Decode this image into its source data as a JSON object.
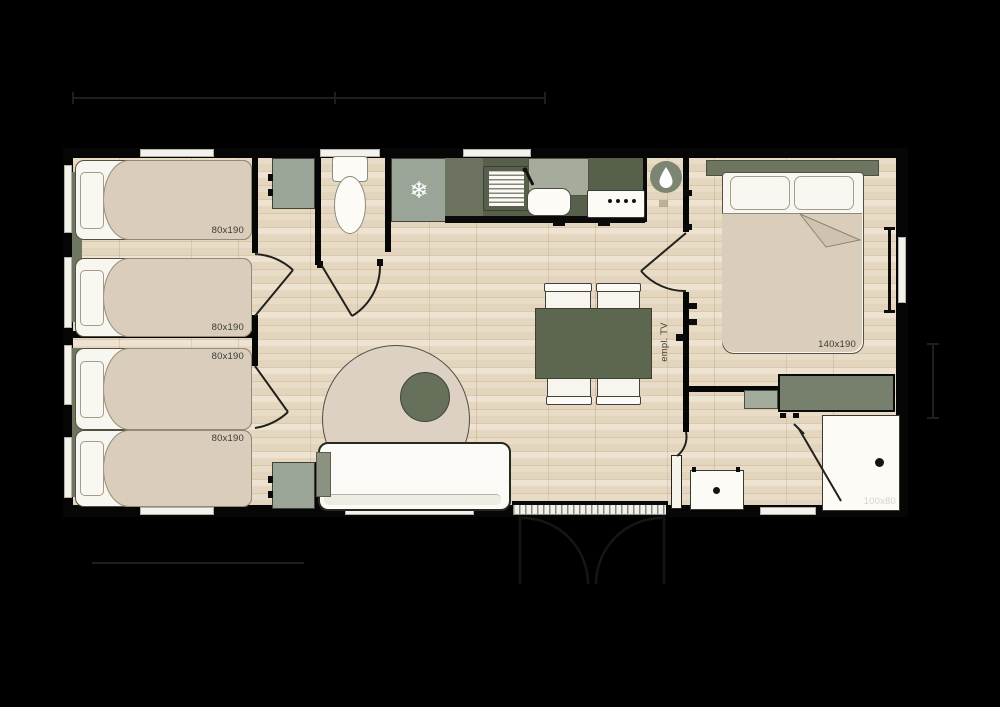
{
  "plan_type": "mobile-home floor plan",
  "labels": {
    "bed_single_1": "80x190",
    "bed_single_2": "80x190",
    "bed_single_3": "80x190",
    "bed_single_4": "80x190",
    "bed_double": "140x190",
    "shower": "100x80",
    "tv_spot": "empl. TV"
  },
  "icons": {
    "freezer_glyph": "❄",
    "water_heater": "water-drop",
    "shower_drain": "dot",
    "washbasin_drain": "dot"
  },
  "colors": {
    "wall": "#060606",
    "counter": "#57604b",
    "sage": "#9aa598",
    "sage_dark": "#77806d",
    "table": "#5d6750",
    "bed": "#dacdbc",
    "white": "#f8f6f0",
    "rug": "#dcd1c3",
    "label_dark": "#3c3c34",
    "label_light": "#d6d4c9"
  }
}
